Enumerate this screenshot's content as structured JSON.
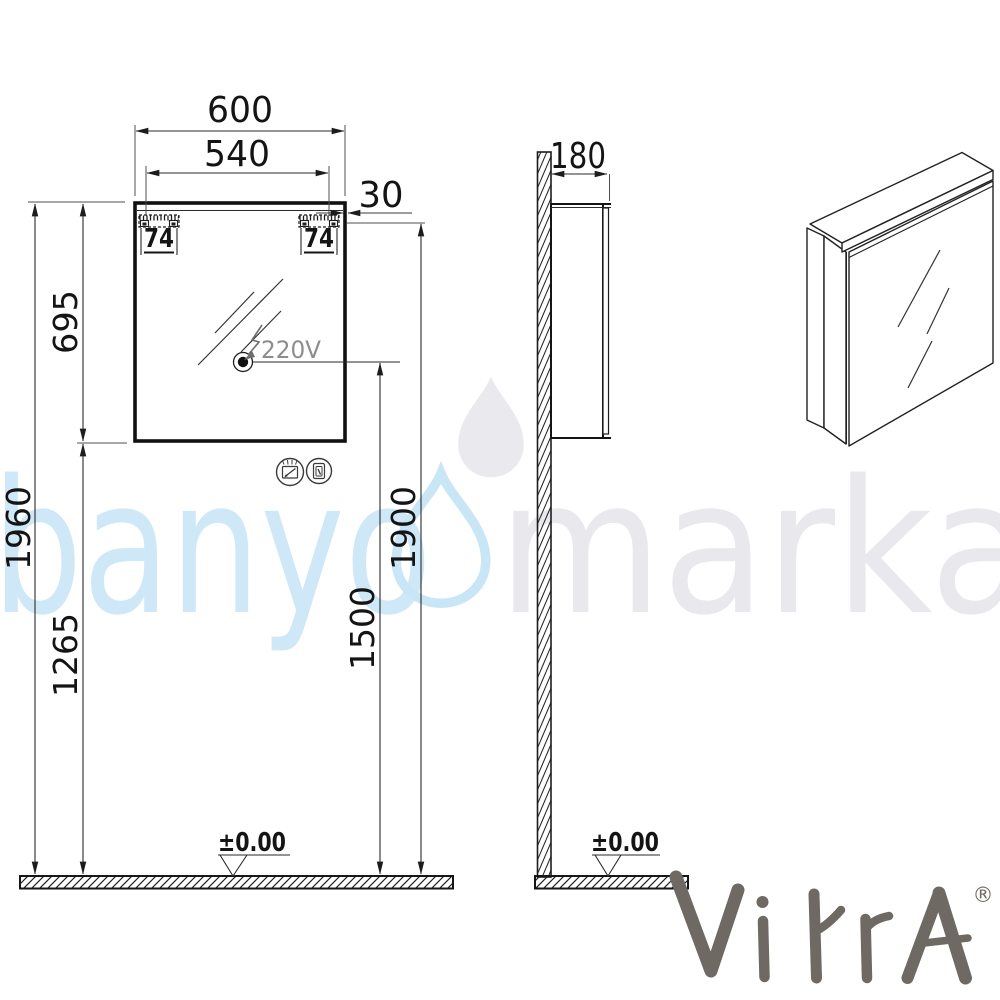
{
  "watermark": {
    "word_left": "banyo",
    "word_right": "marka",
    "blue": "#cfe8f7",
    "gray": "#e9e9ed"
  },
  "branding": {
    "logo": "VitrA",
    "registered": "®",
    "color": "#6e6963"
  },
  "front_view": {
    "width": "600",
    "door_width": "540",
    "side_panel": "30",
    "bracket_left": "74",
    "bracket_right": "74",
    "cabinet_height": "695",
    "total_height": "1960",
    "bottom_height": "1265",
    "top_height": "1900",
    "outlet_height": "1500",
    "voltage": "220V",
    "floor_level": "±0.00"
  },
  "side_view": {
    "depth": "180",
    "floor_level": "±0.00"
  },
  "icons": {
    "left": "heated-mirror-icon",
    "right": "switch-icon"
  }
}
